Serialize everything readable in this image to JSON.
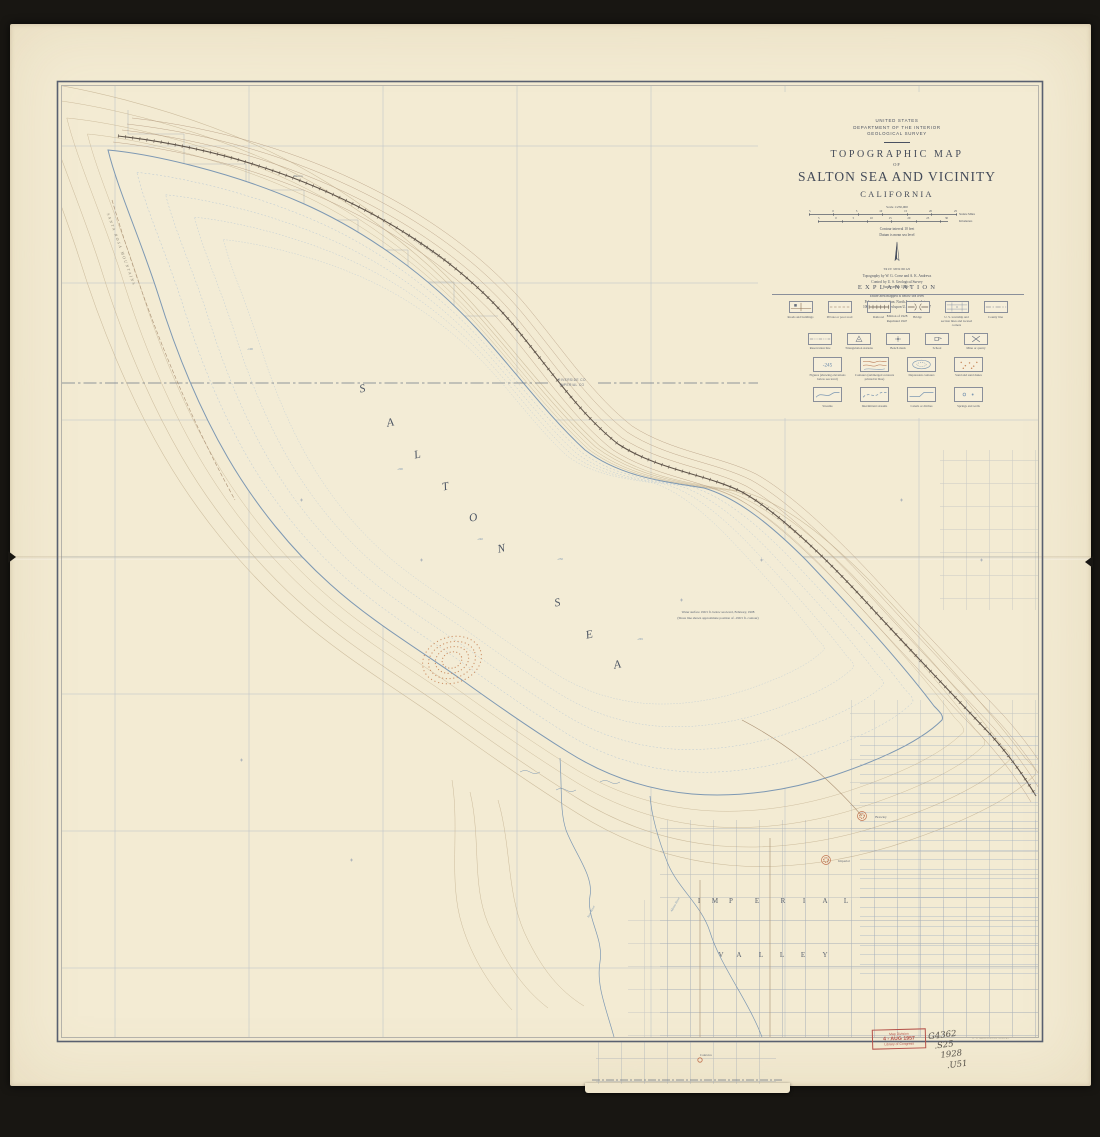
{
  "colors": {
    "paper": "#f3ebd3",
    "frame": "#181612",
    "ink": "#434a58",
    "water_blue": "#7d98b3",
    "contour_brown": "#bca886",
    "grid_blue": "#aab6c4",
    "feature_red": "#c0714e",
    "stamp_red": "#b5524a"
  },
  "header": {
    "agency1": "UNITED STATES",
    "agency2": "DEPARTMENT OF THE INTERIOR",
    "agency3": "GEOLOGICAL SURVEY",
    "map_type": "TOPOGRAPHIC MAP",
    "of": "OF",
    "title": "SALTON SEA AND VICINITY",
    "state": "CALIFORNIA",
    "scale": "Scale 1:250,000",
    "miles_ticks": [
      "5",
      "0",
      "5",
      "10",
      "15",
      "20",
      "25"
    ],
    "miles_label": "Statute Miles",
    "km_ticks": [
      "5",
      "0",
      "5",
      "10",
      "15",
      "20",
      "25",
      "30"
    ],
    "km_label": "Kilometers",
    "contour_interval": "Contour interval 10 feet",
    "datum": "Datum is mean sea level",
    "declination_label": "TRUE MERIDIAN",
    "credit1": "Topography by W. G. Corse and A. K. Andrews",
    "credit2": "Control by U. S. Geological Survey",
    "credit3": "Surveyed in 1906-7",
    "note1": "Entire area mapped is below sea level",
    "note2": "Polyconic projection. North American datum",
    "note3": "1000-yard grid based upon U. S. zone system 7",
    "edition1": "Edition of 1928",
    "edition2": "Reprinted 1947"
  },
  "legend": {
    "title": "EXPLANATION",
    "rows": [
      [
        {
          "symbol": "roads-buildings",
          "label": "Roads and buildings"
        },
        {
          "symbol": "private-road",
          "label": "Private or poor road"
        },
        {
          "symbol": "railroad",
          "label": "Railroad"
        },
        {
          "symbol": "bridge",
          "label": "Bridge"
        },
        {
          "symbol": "township-lines",
          "label": "U. S. township and section lines and located corners"
        },
        {
          "symbol": "county-line",
          "label": "County line"
        }
      ],
      [
        {
          "symbol": "reservation-line",
          "label": "Reservation line"
        },
        {
          "symbol": "triangulation-station",
          "label": "Triangulation stations"
        },
        {
          "symbol": "bench-mark",
          "label": "Bench mark"
        },
        {
          "symbol": "school",
          "label": "School"
        },
        {
          "symbol": "mine-quarry",
          "label": "Mine or quarry"
        }
      ],
      [
        {
          "symbol": "figures",
          "label": "Figures (showing elevations below sea level)",
          "sample": "-245"
        },
        {
          "symbol": "contours",
          "label": "Contours (submerged contours printed in blue)"
        },
        {
          "symbol": "depression-contours",
          "label": "Depression contours"
        },
        {
          "symbol": "sand-dunes",
          "label": "Sand and sand dunes"
        }
      ],
      [
        {
          "symbol": "streams",
          "label": "Streams"
        },
        {
          "symbol": "intermittent-streams",
          "label": "Intermittent streams"
        },
        {
          "symbol": "canals-ditches",
          "label": "Canals or ditches"
        },
        {
          "symbol": "springs-wells",
          "label": "Springs and wells"
        }
      ]
    ]
  },
  "map": {
    "sea_name": [
      {
        "ch": "S",
        "x": 363,
        "y": 392
      },
      {
        "ch": "A",
        "x": 391,
        "y": 426
      },
      {
        "ch": "L",
        "x": 418,
        "y": 458
      },
      {
        "ch": "T",
        "x": 446,
        "y": 490
      },
      {
        "ch": "O",
        "x": 474,
        "y": 521
      },
      {
        "ch": "N",
        "x": 502,
        "y": 552
      },
      {
        "ch": "S",
        "x": 558,
        "y": 606
      },
      {
        "ch": "E",
        "x": 590,
        "y": 638
      },
      {
        "ch": "A",
        "x": 618,
        "y": 668
      }
    ],
    "valley_name": [
      {
        "ch": "I",
        "x": 699,
        "y": 903
      },
      {
        "ch": "M",
        "x": 715,
        "y": 903
      },
      {
        "ch": "P",
        "x": 731,
        "y": 903
      },
      {
        "ch": "E",
        "x": 757,
        "y": 903
      },
      {
        "ch": "R",
        "x": 783,
        "y": 903
      },
      {
        "ch": "I",
        "x": 804,
        "y": 903
      },
      {
        "ch": "A",
        "x": 825,
        "y": 903
      },
      {
        "ch": "L",
        "x": 846,
        "y": 903
      },
      {
        "ch": "V",
        "x": 721,
        "y": 957
      },
      {
        "ch": "A",
        "x": 739,
        "y": 957
      },
      {
        "ch": "L",
        "x": 761,
        "y": 957
      },
      {
        "ch": "L",
        "x": 782,
        "y": 957
      },
      {
        "ch": "E",
        "x": 803,
        "y": 957
      },
      {
        "ch": "Y",
        "x": 825,
        "y": 957
      }
    ],
    "water_note_line1": "Water surface 199.5 ft. below sea level, February, 1908",
    "water_note_line2": "(Shore line shown approximate position of -199.5 ft. contour)",
    "labels": [
      {
        "text": "RIVERSIDE CO",
        "x": 572,
        "y": 381,
        "size": 3.2,
        "color": "#6b7280",
        "spacing": 0.4,
        "sans": true,
        "name": "county-label-north"
      },
      {
        "text": "IMPERIAL CO",
        "x": 572,
        "y": 386,
        "size": 3.2,
        "color": "#6b7280",
        "spacing": 0.4,
        "sans": true,
        "name": "county-label-south"
      },
      {
        "text": "SANTA ROSA MOUNTAINS",
        "x": 120,
        "y": 250,
        "size": 4,
        "rotate": 70,
        "spacing": 1.6,
        "color": "#8b8576",
        "italic": true,
        "name": "mountains-label"
      },
      {
        "text": "SOUTHERN PACIFIC R.R.",
        "x": 428,
        "y": 250,
        "size": 3.3,
        "rotate": 34,
        "spacing": 0.8,
        "color": "#6d655c",
        "name": "railroad-label"
      },
      {
        "text": "Mecca",
        "x": 298,
        "y": 177,
        "size": 3.4,
        "color": "#5f6775",
        "name": "town-label-mecca"
      },
      {
        "text": "Brawley",
        "x": 881,
        "y": 818,
        "size": 3.4,
        "color": "#5f6775",
        "name": "town-label-brawley"
      },
      {
        "text": "Imperial",
        "x": 844,
        "y": 862,
        "size": 3.4,
        "color": "#5f6775",
        "name": "town-label-imperial"
      },
      {
        "text": "Calexico",
        "x": 706,
        "y": 1056,
        "size": 3.4,
        "color": "#5f6775",
        "name": "town-label-calexico"
      },
      {
        "text": "New River",
        "x": 592,
        "y": 912,
        "size": 3.2,
        "rotate": -62,
        "color": "#7d98b3",
        "italic": true,
        "name": "river-label-new"
      },
      {
        "text": "Alamo River",
        "x": 676,
        "y": 905,
        "size": 3.2,
        "rotate": -60,
        "color": "#7d98b3",
        "italic": true,
        "name": "river-label-alamo"
      },
      {
        "text": "-100",
        "x": 250,
        "y": 350,
        "size": 3.2,
        "color": "#7d98b3",
        "name": "depth-figure"
      },
      {
        "text": "-200",
        "x": 400,
        "y": 470,
        "size": 3.2,
        "color": "#7d98b3",
        "name": "depth-figure"
      },
      {
        "text": "-240",
        "x": 480,
        "y": 540,
        "size": 3.2,
        "color": "#7d98b3",
        "name": "depth-figure"
      },
      {
        "text": "-250",
        "x": 560,
        "y": 560,
        "size": 3.2,
        "color": "#7d98b3",
        "name": "depth-figure"
      },
      {
        "text": "-265",
        "x": 640,
        "y": 640,
        "size": 3.2,
        "color": "#7d98b3",
        "name": "depth-figure"
      }
    ]
  },
  "stamp": {
    "line1": "Map Division",
    "line2": "4 - AUG 1957",
    "line3": "Library of Congress"
  },
  "pencil": {
    "lines": [
      "G4362",
      ".S25",
      "1928",
      ".U51"
    ]
  },
  "print_note": "U. S. GEOLOGICAL SURVEY"
}
